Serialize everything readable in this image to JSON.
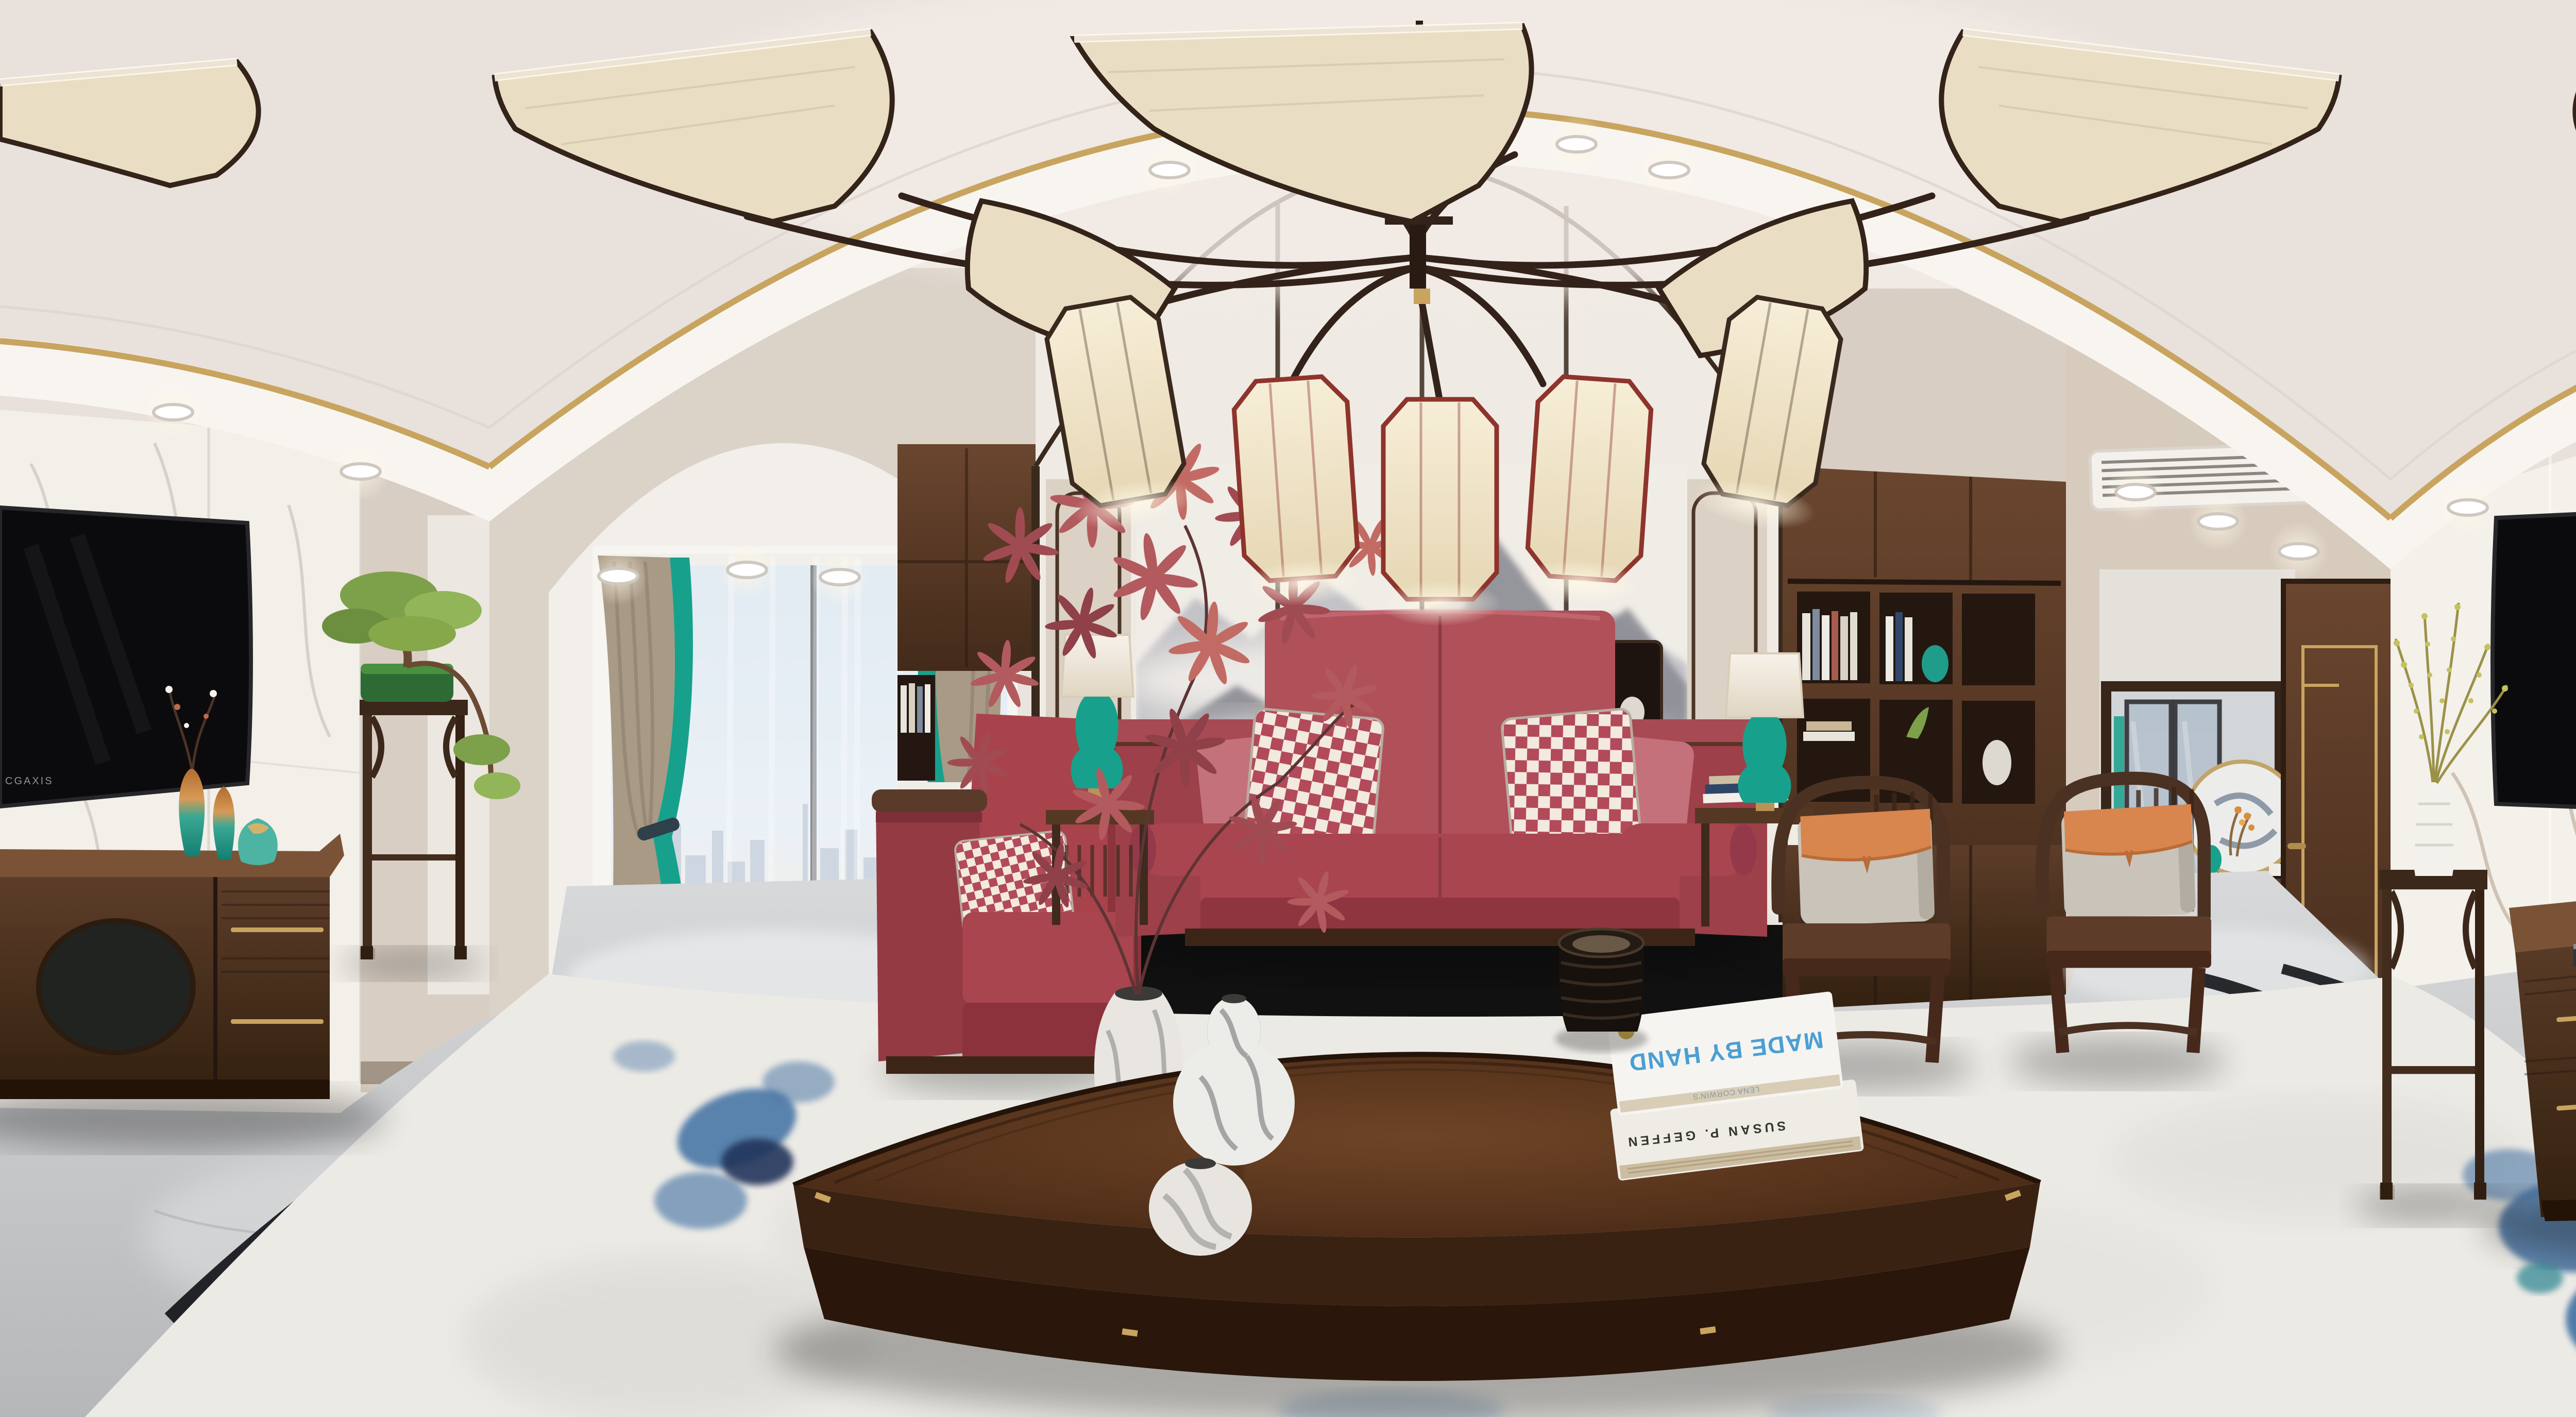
{
  "texts": {
    "tv_watermark": "CGAXIS",
    "book_author": "LENA CORWIN'S",
    "book_title": "MADE BY HAND",
    "book_spine": "SUSAN P. GEFFEN"
  },
  "palette": {
    "ceiling": "#e8e1dc",
    "cove_white": "#f8f5f1",
    "gold_trim": "#c8a45f",
    "marble_white": "#f3efe9",
    "marble_vein_brown": "#8d6f52",
    "wall_beige": "#d9cec3",
    "wood_dark": "#4a3123",
    "wood_mid": "#6b4630",
    "sofa_red": "#b05059",
    "checker_red": "#b24a5a",
    "pillow_cream": "#f2e9df",
    "armchair_red": "#a8434c",
    "teal_accent": "#17a18c",
    "curtain_taupe": "#a89a85",
    "orange_accent": "#d8854e",
    "mural_grey": "#7d7d85",
    "floor_grey": "#cbccce",
    "floor_inlay_black": "#17181b",
    "rug_cream": "#eceae5",
    "rug_blue": "#3f6fa3",
    "title_blue": "#4a9fd4"
  }
}
